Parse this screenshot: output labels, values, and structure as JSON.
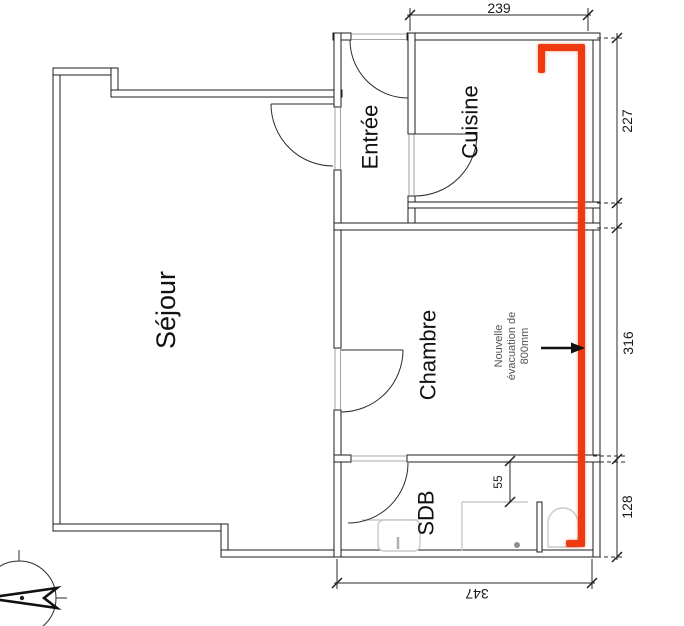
{
  "rooms": {
    "sejour": "Séjour",
    "entree": "Entrée",
    "cuisine": "Cuisine",
    "chambre": "Chambre",
    "sdb": "SDB"
  },
  "dimensions": {
    "cuisine_width": "239",
    "cuisine_height": "227",
    "chambre_height": "316",
    "sdb_height": "128",
    "block_width": "347",
    "shower_offset": "55"
  },
  "annotation": {
    "line1": "Nouvelle",
    "line2": "évacuation de",
    "line3": "800mm"
  },
  "icons": {
    "north_arrow": "north-arrow",
    "evacuation_arrow": "arrow-right"
  },
  "colors": {
    "duct": "#ee3a10",
    "walls": "#1d1d1d",
    "fixtures": "#c9c9c9",
    "annotation_text": "#555555"
  }
}
